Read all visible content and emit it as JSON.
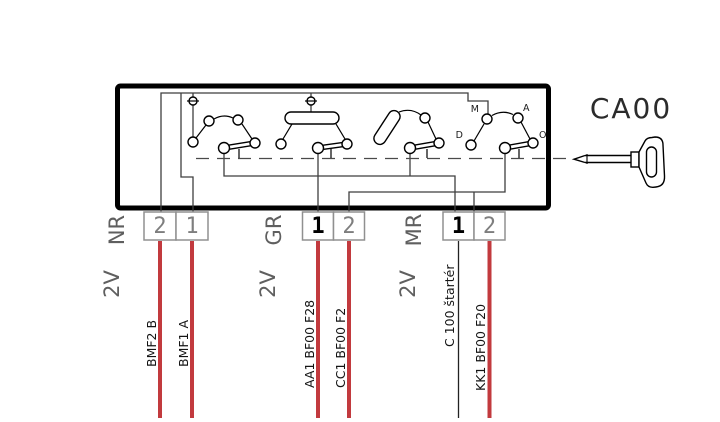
{
  "component": {
    "code": "CA00"
  },
  "positions": {
    "d": "D",
    "m": "M",
    "a": "A",
    "o": "O"
  },
  "connectors": [
    {
      "label": "NR",
      "gauge": "2V",
      "terminals": [
        {
          "number": "2",
          "wire_label": "BMF2 B"
        },
        {
          "number": "1",
          "wire_label": "BMF1 A"
        }
      ]
    },
    {
      "label": "GR",
      "gauge": "2V",
      "terminals": [
        {
          "number": "1",
          "wire_label": "AA1 BF00  F28"
        },
        {
          "number": "2",
          "wire_label": "CC1 BF00  F2"
        }
      ]
    },
    {
      "label": "MR",
      "gauge": "2V",
      "terminals": [
        {
          "number": "1",
          "wire_label": "C 100 štartér"
        },
        {
          "number": "2",
          "wire_label": "KK1 BF00  F20"
        }
      ]
    }
  ],
  "colors": {
    "wire_red": "#c23a3e",
    "wire_black": "#222222"
  }
}
